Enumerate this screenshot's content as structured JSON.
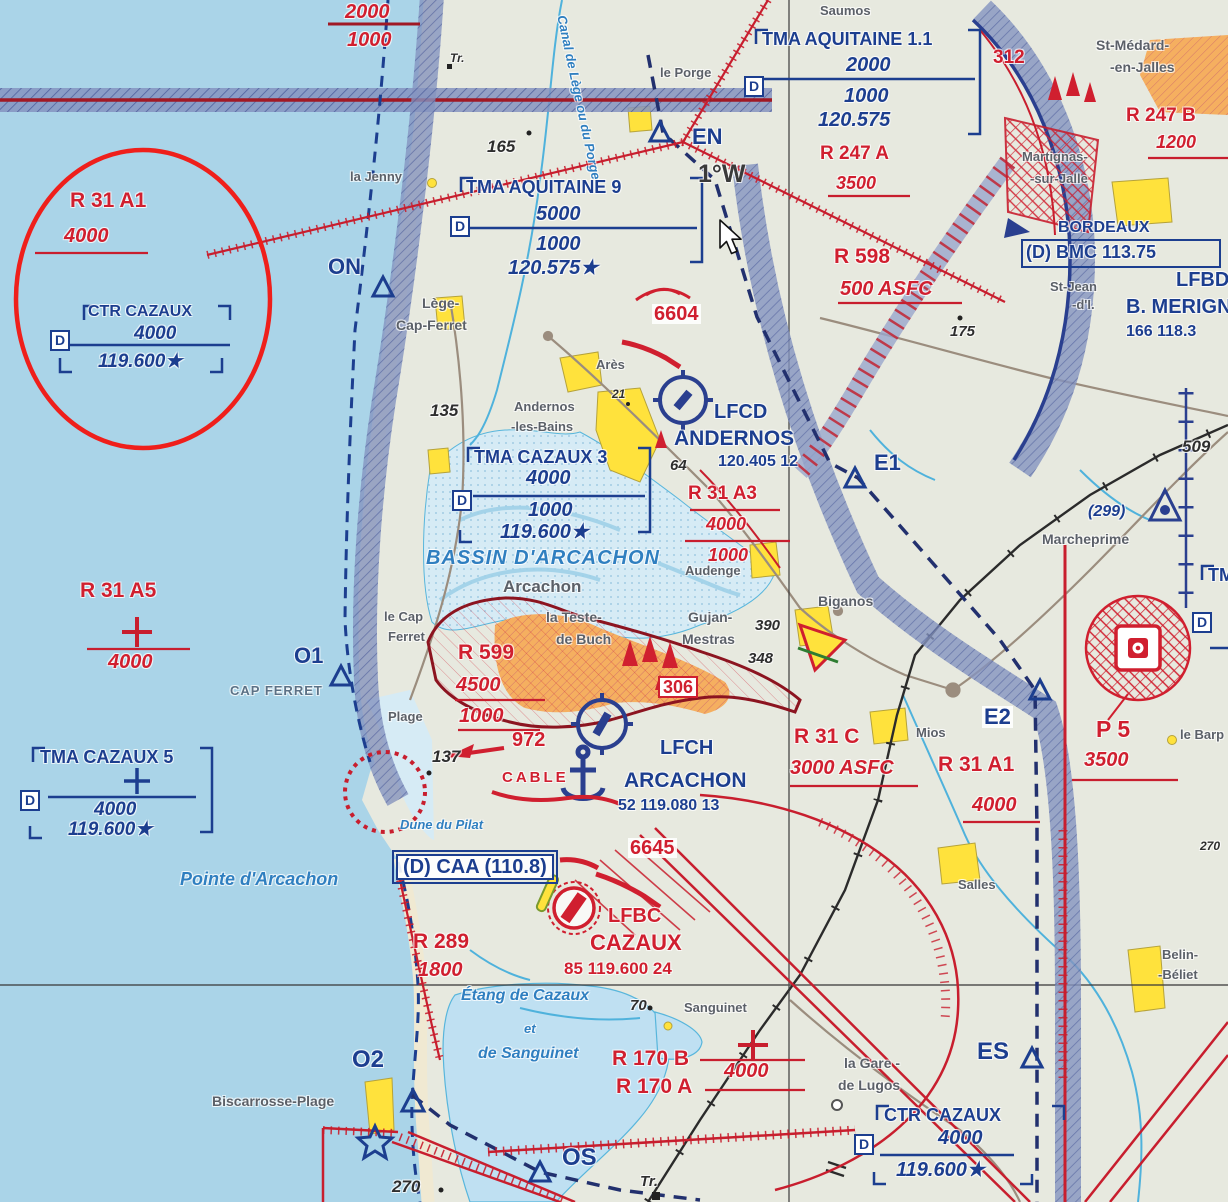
{
  "meta": {
    "title": "Carte VFR – Bassin d'Arcachon / CTR Cazaux"
  },
  "colors": {
    "sea": "#aad4e8",
    "land": "#e7e9df",
    "bassin": "#d6ebf5",
    "lake": "#bfe0f2",
    "band": "#8593bf",
    "band_hatch": "#39498f",
    "aero_blue": "#1c3e8f",
    "zone_red": "#d01f2f",
    "dark_red": "#a01824",
    "urban": "#f5af60",
    "village_yellow": "#ffe23c",
    "town_gray": "#5b6068",
    "water_blue": "#2f7fc0",
    "spot": "#2e2e2e",
    "rail": "#2b2b2b",
    "road": "#9b8d7e",
    "annotation": "#ef1f1b"
  },
  "labels": [
    {
      "n": "airway-alt-upper",
      "t": "2000",
      "x": 345,
      "y": 2,
      "c": "red-ital lg"
    },
    {
      "n": "airway-alt-lower",
      "t": "1000",
      "x": 347,
      "y": 30,
      "c": "red-ital lg"
    },
    {
      "n": "r31a1-nw-title",
      "t": "R 31 A1",
      "x": 70,
      "y": 190,
      "c": "red-zone lg"
    },
    {
      "n": "r31a1-nw-alt",
      "t": "4000",
      "x": 64,
      "y": 226,
      "c": "red-ital lg"
    },
    {
      "n": "ctr-cazaux-nw-title",
      "t": "CTR CAZAUX",
      "x": 88,
      "y": 304,
      "c": "blue-box-title sm"
    },
    {
      "n": "ctr-cazaux-nw-alt",
      "t": "4000",
      "x": 134,
      "y": 324,
      "c": "blue-ital"
    },
    {
      "n": "ctr-cazaux-nw-freq",
      "t": "119.600★",
      "x": 98,
      "y": 352,
      "c": "blue-ital"
    },
    {
      "n": "ctr-cazaux-nw-d-badge",
      "t": "D",
      "x": 50,
      "y": 330,
      "c": "dbadge"
    },
    {
      "n": "wpt-on",
      "t": "ON",
      "x": 328,
      "y": 256,
      "c": "wpt"
    },
    {
      "n": "town-la-jenny",
      "t": "la Jenny",
      "x": 350,
      "y": 170,
      "c": "town-sm"
    },
    {
      "n": "tr-mark-north",
      "t": "Tr.",
      "x": 450,
      "y": 52,
      "c": "spot-sm"
    },
    {
      "n": "canal-lege-label",
      "t": "Canal de Lège ou du Porge",
      "x": 568,
      "y": 14,
      "c": "water-sm",
      "r": 78
    },
    {
      "n": "town-le-porge",
      "t": "le Porge",
      "x": 660,
      "y": 66,
      "c": "town-sm"
    },
    {
      "n": "town-saumos",
      "t": "Saumos",
      "x": 820,
      "y": 4,
      "c": "town-sm"
    },
    {
      "n": "tma-aquitaine-11-title",
      "t": "TMA AQUITAINE 1.1",
      "x": 762,
      "y": 30,
      "c": "blue-box-title"
    },
    {
      "n": "tma-aquitaine-11-upper",
      "t": "2000",
      "x": 846,
      "y": 55,
      "c": "blue-ital lg"
    },
    {
      "n": "tma-aquitaine-11-lower",
      "t": "1000",
      "x": 844,
      "y": 86,
      "c": "blue-ital lg"
    },
    {
      "n": "tma-aquitaine-11-freq",
      "t": "120.575",
      "x": 818,
      "y": 110,
      "c": "blue-ital lg"
    },
    {
      "n": "tma-aquitaine-11-d-badge",
      "t": "D",
      "x": 744,
      "y": 76,
      "c": "dbadge"
    },
    {
      "n": "spot-165",
      "t": "165",
      "x": 487,
      "y": 138,
      "c": "spot lg"
    },
    {
      "n": "tma-aquitaine-9-title",
      "t": "TMA AQUITAINE 9",
      "x": 466,
      "y": 178,
      "c": "blue-box-title"
    },
    {
      "n": "tma-aquitaine-9-upper",
      "t": "5000",
      "x": 536,
      "y": 204,
      "c": "blue-ital lg"
    },
    {
      "n": "tma-aquitaine-9-lower",
      "t": "1000",
      "x": 536,
      "y": 234,
      "c": "blue-ital lg"
    },
    {
      "n": "tma-aquitaine-9-freq",
      "t": "120.575★",
      "x": 508,
      "y": 258,
      "c": "blue-ital lg"
    },
    {
      "n": "tma-aquitaine-9-d-badge",
      "t": "D",
      "x": 450,
      "y": 216,
      "c": "dbadge"
    },
    {
      "n": "wpt-en",
      "t": "EN",
      "x": 692,
      "y": 126,
      "c": "wpt"
    },
    {
      "n": "declination-label",
      "t": "1°W",
      "x": 698,
      "y": 162,
      "c": "decl"
    },
    {
      "n": "obstacle-312",
      "t": "312",
      "x": 993,
      "y": 48,
      "c": "red-zone"
    },
    {
      "n": "town-st-medard-1",
      "t": "St-Médard-",
      "x": 1096,
      "y": 38,
      "c": "town"
    },
    {
      "n": "town-st-medard-2",
      "t": "-en-Jalles",
      "x": 1110,
      "y": 60,
      "c": "town"
    },
    {
      "n": "r247b-title",
      "t": "R 247 B",
      "x": 1126,
      "y": 106,
      "c": "red-zone"
    },
    {
      "n": "r247b-alt",
      "t": "1200",
      "x": 1156,
      "y": 133,
      "c": "red-ital"
    },
    {
      "n": "r247a-title",
      "t": "R 247 A",
      "x": 820,
      "y": 144,
      "c": "red-zone"
    },
    {
      "n": "r247a-alt",
      "t": "3500",
      "x": 836,
      "y": 174,
      "c": "red-ital"
    },
    {
      "n": "town-martignas-1",
      "t": "Martignas-",
      "x": 1022,
      "y": 150,
      "c": "town-sm"
    },
    {
      "n": "town-martignas-2",
      "t": "-sur-Jalle",
      "x": 1030,
      "y": 172,
      "c": "town-sm"
    },
    {
      "n": "bordeaux-title",
      "t": "BORDEAUX",
      "x": 1058,
      "y": 220,
      "c": "blue-box-title sm"
    },
    {
      "n": "bordeaux-bmc",
      "t": "(D) BMC 113.75",
      "x": 1026,
      "y": 243,
      "c": "blue-box-title"
    },
    {
      "n": "town-st-jean-1",
      "t": "St-Jean",
      "x": 1050,
      "y": 280,
      "c": "town-sm"
    },
    {
      "n": "town-st-jean-2",
      "t": "-d'I.",
      "x": 1072,
      "y": 298,
      "c": "town-sm"
    },
    {
      "n": "lfbd-code",
      "t": "LFBD",
      "x": 1176,
      "y": 270,
      "c": "blue-airport"
    },
    {
      "n": "merignac-name",
      "t": "B. MERIGNAC",
      "x": 1126,
      "y": 297,
      "c": "blue-airport"
    },
    {
      "n": "merignac-data",
      "t": "166  118.3",
      "x": 1126,
      "y": 324,
      "c": "blue-data"
    },
    {
      "n": "r598-title",
      "t": "R 598",
      "x": 834,
      "y": 246,
      "c": "red-zone lg"
    },
    {
      "n": "r598-alt",
      "t": "500 ASFC",
      "x": 840,
      "y": 279,
      "c": "red-ital lg"
    },
    {
      "n": "spot-175",
      "t": "175",
      "x": 950,
      "y": 324,
      "c": "spot"
    },
    {
      "n": "town-lege-1",
      "t": "Lège-",
      "x": 422,
      "y": 296,
      "c": "town"
    },
    {
      "n": "town-lege-2",
      "t": "Cap-Ferret",
      "x": 396,
      "y": 318,
      "c": "town"
    },
    {
      "n": "spot-135",
      "t": "135",
      "x": 430,
      "y": 402,
      "c": "spot lg"
    },
    {
      "n": "town-andernos-1",
      "t": "Andernos",
      "x": 514,
      "y": 400,
      "c": "town-sm"
    },
    {
      "n": "town-andernos-2",
      "t": "-les-Bains",
      "x": 511,
      "y": 420,
      "c": "town-sm"
    },
    {
      "n": "tma-cazaux-3-title",
      "t": "TMA CAZAUX 3",
      "x": 474,
      "y": 448,
      "c": "blue-box-title"
    },
    {
      "n": "tma-cazaux-3-upper",
      "t": "4000",
      "x": 526,
      "y": 468,
      "c": "blue-ital lg"
    },
    {
      "n": "tma-cazaux-3-lower",
      "t": "1000",
      "x": 528,
      "y": 500,
      "c": "blue-ital lg"
    },
    {
      "n": "tma-cazaux-3-freq",
      "t": "119.600★",
      "x": 500,
      "y": 522,
      "c": "blue-ital lg"
    },
    {
      "n": "tma-cazaux-3-d-badge",
      "t": "D",
      "x": 452,
      "y": 490,
      "c": "dbadge"
    },
    {
      "n": "bassin-darcachon-label",
      "t": "BASSIN D'ARCACHON",
      "x": 426,
      "y": 548,
      "c": "water-lg"
    },
    {
      "n": "town-arcachon",
      "t": "Arcachon",
      "x": 503,
      "y": 578,
      "c": "town-lg"
    },
    {
      "n": "obstacle-6604",
      "t": "6604",
      "x": 652,
      "y": 304,
      "c": "red-ob lg wbg"
    },
    {
      "n": "town-ares",
      "t": "Arès",
      "x": 596,
      "y": 358,
      "c": "town-sm"
    },
    {
      "n": "spot-21",
      "t": "21",
      "x": 612,
      "y": 388,
      "c": "spot-sm"
    },
    {
      "n": "lfcd-code",
      "t": "LFCD",
      "x": 714,
      "y": 402,
      "c": "blue-airport"
    },
    {
      "n": "andernos-airport-name",
      "t": "ANDERNOS",
      "x": 674,
      "y": 428,
      "c": "blue-airport lg"
    },
    {
      "n": "andernos-airport-data",
      "t": "120.405 12",
      "x": 718,
      "y": 454,
      "c": "blue-data"
    },
    {
      "n": "spot-64",
      "t": "64",
      "x": 670,
      "y": 458,
      "c": "spot"
    },
    {
      "n": "r31a3-title",
      "t": "R 31 A3",
      "x": 688,
      "y": 484,
      "c": "red-zone"
    },
    {
      "n": "r31a3-upper",
      "t": "4000",
      "x": 706,
      "y": 515,
      "c": "red-ital"
    },
    {
      "n": "r31a3-lower",
      "t": "1000",
      "x": 708,
      "y": 546,
      "c": "red-ital"
    },
    {
      "n": "town-audenge",
      "t": "Audenge",
      "x": 685,
      "y": 564,
      "c": "town-sm"
    },
    {
      "n": "wpt-e1",
      "t": "E1",
      "x": 874,
      "y": 452,
      "c": "wpt"
    },
    {
      "n": "obstacle-509",
      "t": "509",
      "x": 1182,
      "y": 438,
      "c": "spot lg"
    },
    {
      "n": "obstacle-299",
      "t": "(299)",
      "x": 1088,
      "y": 504,
      "c": "blue-data ital"
    },
    {
      "n": "town-marcheprime",
      "t": "Marcheprime",
      "x": 1042,
      "y": 532,
      "c": "town"
    },
    {
      "n": "town-la-teste-1",
      "t": "la Teste-",
      "x": 546,
      "y": 610,
      "c": "town"
    },
    {
      "n": "town-la-teste-2",
      "t": "de Buch",
      "x": 556,
      "y": 632,
      "c": "town"
    },
    {
      "n": "town-gujan-1",
      "t": "Gujan-",
      "x": 688,
      "y": 610,
      "c": "town"
    },
    {
      "n": "town-gujan-2",
      "t": "Mestras",
      "x": 682,
      "y": 632,
      "c": "town"
    },
    {
      "n": "spot-390",
      "t": "390",
      "x": 755,
      "y": 618,
      "c": "spot"
    },
    {
      "n": "spot-348",
      "t": "348",
      "x": 748,
      "y": 651,
      "c": "spot"
    },
    {
      "n": "r599-title",
      "t": "R 599",
      "x": 458,
      "y": 642,
      "c": "red-zone lg"
    },
    {
      "n": "r599-upper",
      "t": "4500",
      "x": 456,
      "y": 675,
      "c": "red-ital lg"
    },
    {
      "n": "r599-lower",
      "t": "1000",
      "x": 459,
      "y": 706,
      "c": "red-ital lg"
    },
    {
      "n": "town-le-cap-1",
      "t": "le Cap",
      "x": 384,
      "y": 610,
      "c": "town-sm"
    },
    {
      "n": "town-le-cap-2",
      "t": "Ferret",
      "x": 388,
      "y": 630,
      "c": "town-sm"
    },
    {
      "n": "town-plage",
      "t": "Plage",
      "x": 388,
      "y": 710,
      "c": "town-sm"
    },
    {
      "n": "spot-137",
      "t": "137",
      "x": 432,
      "y": 748,
      "c": "spot lg"
    },
    {
      "n": "obstacle-972",
      "t": "972",
      "x": 512,
      "y": 730,
      "c": "red-ob lg"
    },
    {
      "n": "cable-label",
      "t": "CABLE",
      "x": 502,
      "y": 770,
      "c": "red-ob cable"
    },
    {
      "n": "obstacle-306",
      "t": "306",
      "x": 658,
      "y": 676,
      "c": "red-ob boxed306"
    },
    {
      "n": "wpt-o1",
      "t": "O1",
      "x": 294,
      "y": 645,
      "c": "wpt"
    },
    {
      "n": "cap-ferret-point-label",
      "t": "CAP FERRET",
      "x": 230,
      "y": 684,
      "c": "cap-label"
    },
    {
      "n": "r31a5-title",
      "t": "R 31 A5",
      "x": 80,
      "y": 580,
      "c": "red-zone lg"
    },
    {
      "n": "r31a5-alt",
      "t": "4000",
      "x": 108,
      "y": 652,
      "c": "red-ital lg"
    },
    {
      "n": "lfch-code",
      "t": "LFCH",
      "x": 660,
      "y": 738,
      "c": "blue-airport"
    },
    {
      "n": "arcachon-airport-name",
      "t": "ARCACHON",
      "x": 624,
      "y": 770,
      "c": "blue-airport lg"
    },
    {
      "n": "arcachon-airport-data",
      "t": "52  119.080 13",
      "x": 618,
      "y": 798,
      "c": "blue-data"
    },
    {
      "n": "town-biganos",
      "t": "Biganos",
      "x": 818,
      "y": 594,
      "c": "town"
    },
    {
      "n": "r31c-title",
      "t": "R 31 C",
      "x": 794,
      "y": 726,
      "c": "red-zone lg"
    },
    {
      "n": "r31c-alt",
      "t": "3000 ASFC",
      "x": 790,
      "y": 758,
      "c": "red-ital lg"
    },
    {
      "n": "r31a1-e-title",
      "t": "R 31 A1",
      "x": 938,
      "y": 754,
      "c": "red-zone lg"
    },
    {
      "n": "r31a1-e-alt",
      "t": "4000",
      "x": 972,
      "y": 795,
      "c": "red-ital lg"
    },
    {
      "n": "wpt-e2",
      "t": "E2",
      "x": 982,
      "y": 706,
      "c": "wpt wbg"
    },
    {
      "n": "town-mios",
      "t": "Mios",
      "x": 916,
      "y": 726,
      "c": "town-sm"
    },
    {
      "n": "p5-title",
      "t": "P 5",
      "x": 1096,
      "y": 718,
      "c": "red-zone xl"
    },
    {
      "n": "p5-alt",
      "t": "3500",
      "x": 1084,
      "y": 750,
      "c": "red-ital lg"
    },
    {
      "n": "town-le-barp",
      "t": "le Barp",
      "x": 1180,
      "y": 728,
      "c": "town-sm"
    },
    {
      "n": "tma-clip-east",
      "t": "TMA",
      "x": 1208,
      "y": 566,
      "c": "blue-box-title"
    },
    {
      "n": "d-badge-east",
      "t": "D",
      "x": 1192,
      "y": 612,
      "c": "dbadge"
    },
    {
      "n": "tma-cazaux-5-title",
      "t": "TMA CAZAUX 5",
      "x": 40,
      "y": 748,
      "c": "blue-box-title"
    },
    {
      "n": "tma-cazaux-5-alt",
      "t": "4000",
      "x": 94,
      "y": 800,
      "c": "blue-ital"
    },
    {
      "n": "tma-cazaux-5-freq",
      "t": "119.600★",
      "x": 68,
      "y": 820,
      "c": "blue-ital"
    },
    {
      "n": "tma-cazaux-5-d-badge",
      "t": "D",
      "x": 20,
      "y": 790,
      "c": "dbadge"
    },
    {
      "n": "pointe-arcachon-label",
      "t": "Pointe d'Arcachon",
      "x": 180,
      "y": 870,
      "c": "water lg"
    },
    {
      "n": "dune-pilat-label",
      "t": "Dune du Pilat",
      "x": 400,
      "y": 818,
      "c": "water-sm"
    },
    {
      "n": "caa-box-label",
      "t": "(D) CAA (110.8)",
      "x": 396,
      "y": 854,
      "c": "blue-box-title xl boxed-blue"
    },
    {
      "n": "r289-title",
      "t": "R 289",
      "x": 413,
      "y": 931,
      "c": "red-zone lg"
    },
    {
      "n": "r289-alt",
      "t": "1800",
      "x": 418,
      "y": 960,
      "c": "red-ital lg"
    },
    {
      "n": "obstacle-6645",
      "t": "6645",
      "x": 628,
      "y": 838,
      "c": "red-ob lg wbg"
    },
    {
      "n": "lfbc-code",
      "t": "LFBC",
      "x": 608,
      "y": 906,
      "c": "red-airport"
    },
    {
      "n": "cazaux-airport-name",
      "t": "CAZAUX",
      "x": 590,
      "y": 932,
      "c": "red-airport lg"
    },
    {
      "n": "cazaux-airport-data",
      "t": "85  119.600 24",
      "x": 564,
      "y": 960,
      "c": "red-airport data"
    },
    {
      "n": "etang-cazaux-label",
      "t": "Étang de Cazaux",
      "x": 461,
      "y": 988,
      "c": "water"
    },
    {
      "n": "etang-et-label",
      "t": "et",
      "x": 524,
      "y": 1022,
      "c": "water-sm"
    },
    {
      "n": "etang-sanguinet-label",
      "t": "de Sanguinet",
      "x": 478,
      "y": 1046,
      "c": "water"
    },
    {
      "n": "spot-70",
      "t": "70",
      "x": 630,
      "y": 998,
      "c": "spot"
    },
    {
      "n": "town-sanguinet",
      "t": "Sanguinet",
      "x": 684,
      "y": 1001,
      "c": "town-sm"
    },
    {
      "n": "wpt-o2",
      "t": "O2",
      "x": 352,
      "y": 1048,
      "c": "wpt lg"
    },
    {
      "n": "town-biscarrosse",
      "t": "Biscarrosse-Plage",
      "x": 212,
      "y": 1094,
      "c": "town"
    },
    {
      "n": "spot-270",
      "t": "270",
      "x": 392,
      "y": 1178,
      "c": "spot lg"
    },
    {
      "n": "r170b-title",
      "t": "R 170 B",
      "x": 612,
      "y": 1048,
      "c": "red-zone lg"
    },
    {
      "n": "r170a-title",
      "t": "R 170 A",
      "x": 616,
      "y": 1076,
      "c": "red-zone lg"
    },
    {
      "n": "r170-alt",
      "t": "4000",
      "x": 724,
      "y": 1061,
      "c": "red-ital lg"
    },
    {
      "n": "town-la-gare-1",
      "t": "la Gare -",
      "x": 844,
      "y": 1056,
      "c": "town"
    },
    {
      "n": "town-la-gare-2",
      "t": "de Lugos",
      "x": 838,
      "y": 1078,
      "c": "town"
    },
    {
      "n": "ctr-cazaux-se-title",
      "t": "CTR CAZAUX",
      "x": 884,
      "y": 1106,
      "c": "blue-box-title"
    },
    {
      "n": "ctr-cazaux-se-alt",
      "t": "4000",
      "x": 938,
      "y": 1128,
      "c": "blue-ital lg"
    },
    {
      "n": "ctr-cazaux-se-freq",
      "t": "119.600★",
      "x": 896,
      "y": 1160,
      "c": "blue-ital lg"
    },
    {
      "n": "ctr-cazaux-se-d-badge",
      "t": "D",
      "x": 854,
      "y": 1134,
      "c": "dbadge"
    },
    {
      "n": "town-salles",
      "t": "Salles",
      "x": 958,
      "y": 878,
      "c": "town-sm"
    },
    {
      "n": "town-belin-1",
      "t": "Belin-",
      "x": 1162,
      "y": 948,
      "c": "town-sm"
    },
    {
      "n": "town-belin-2",
      "t": "-Béliet",
      "x": 1158,
      "y": 968,
      "c": "town-sm"
    },
    {
      "n": "wpt-es",
      "t": "ES",
      "x": 977,
      "y": 1040,
      "c": "wpt lg"
    },
    {
      "n": "wpt-os",
      "t": "OS",
      "x": 562,
      "y": 1146,
      "c": "wpt lg"
    },
    {
      "n": "tr-mark-south",
      "t": "Tr.",
      "x": 640,
      "y": 1174,
      "c": "spot"
    },
    {
      "n": "spot-270-east",
      "t": "270",
      "x": 1200,
      "y": 840,
      "c": "spot-sm"
    }
  ]
}
